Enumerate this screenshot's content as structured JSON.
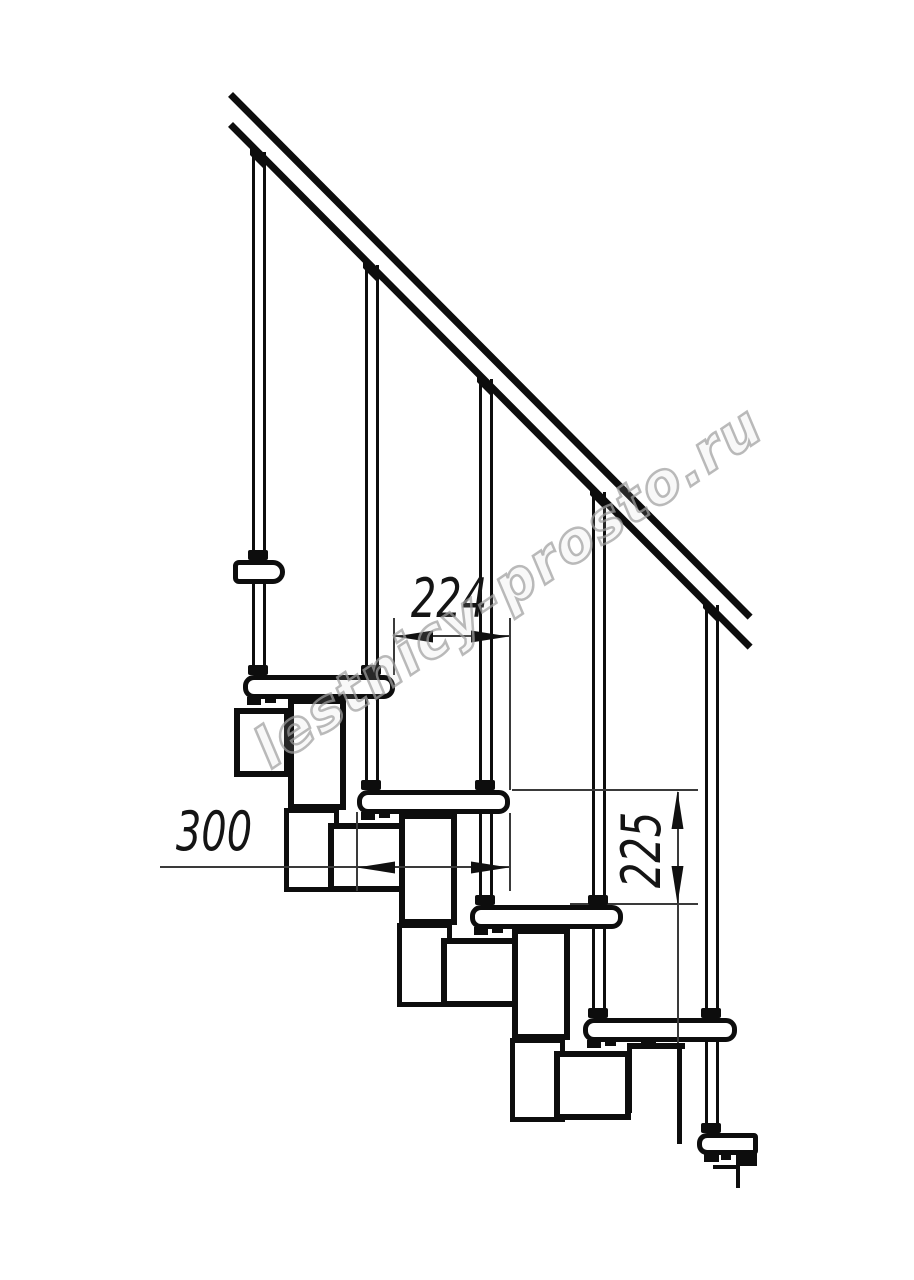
{
  "drawing": {
    "subject": "modular-staircase-side-elevation",
    "watermark": "lestnicy-prosto.ru",
    "dimensions": {
      "step_length": {
        "label": "224",
        "orientation": "horizontal"
      },
      "tread_depth": {
        "label": "300",
        "orientation": "horizontal"
      },
      "step_rise": {
        "label": "225",
        "orientation": "vertical"
      }
    }
  }
}
